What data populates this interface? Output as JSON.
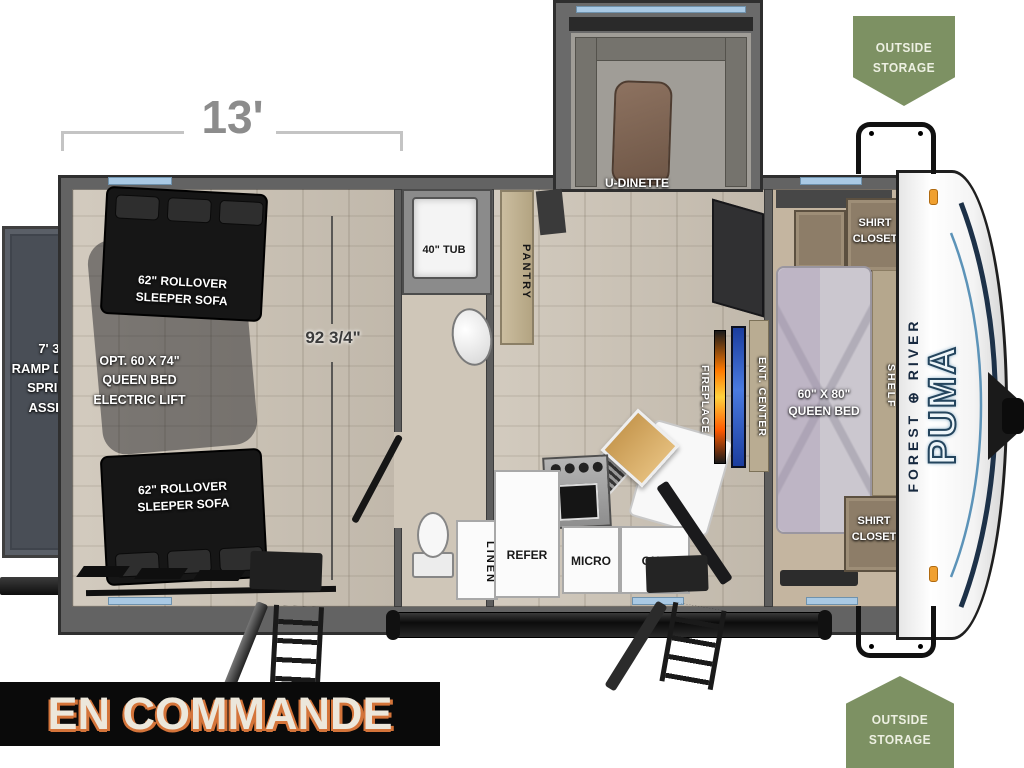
{
  "banner": {
    "text": "EN COMMANDE"
  },
  "dimensions": {
    "width_label": "13'",
    "garage_interior_label": "92 3/4\""
  },
  "badges": {
    "outside_storage": "OUTSIDE\nSTORAGE"
  },
  "labels": {
    "ramp_door": "7' 3\"\nRAMP DOOR\nSPRING\nASSIST",
    "sleeper_sofa": "62\" ROLLOVER\nSLEEPER SOFA",
    "opt_queen_lift": "OPT. 60 X 74\"\nQUEEN BED\nELECTRIC LIFT",
    "u_dinette": "U-DINETTE",
    "pantry": "PANTRY",
    "tub": "40\" TUB",
    "linen": "LINEN",
    "refer": "REFER",
    "micro": "MICRO",
    "ohc": "OHC",
    "fireplace": "FIREPLACE",
    "ent_center": "ENT. CENTER",
    "queen_bed": "60\" X 80\"\nQUEEN BED",
    "shirt_closet": "SHIRT\nCLOSET",
    "shelf": "SHELF"
  },
  "logo": {
    "brand_left": "FOREST",
    "brand_right": "RIVER",
    "globe": "⊕",
    "model": "PUMA"
  },
  "colors": {
    "badge_green": "#7d9163",
    "banner_bg": "#0a0a0a",
    "banner_text": "#ece7db",
    "banner_accent": "#d4743a",
    "window_blue": "#a9c9e4",
    "wall_gray": "#636363",
    "floor_tan": "#cbc2b4",
    "fireplace_orange": "#ff7a00",
    "tv_blue": "#4a7ae0",
    "wood": "#c89a52",
    "brand_navy": "#1c2f4a",
    "puma_blue": "#7fb3d0"
  }
}
